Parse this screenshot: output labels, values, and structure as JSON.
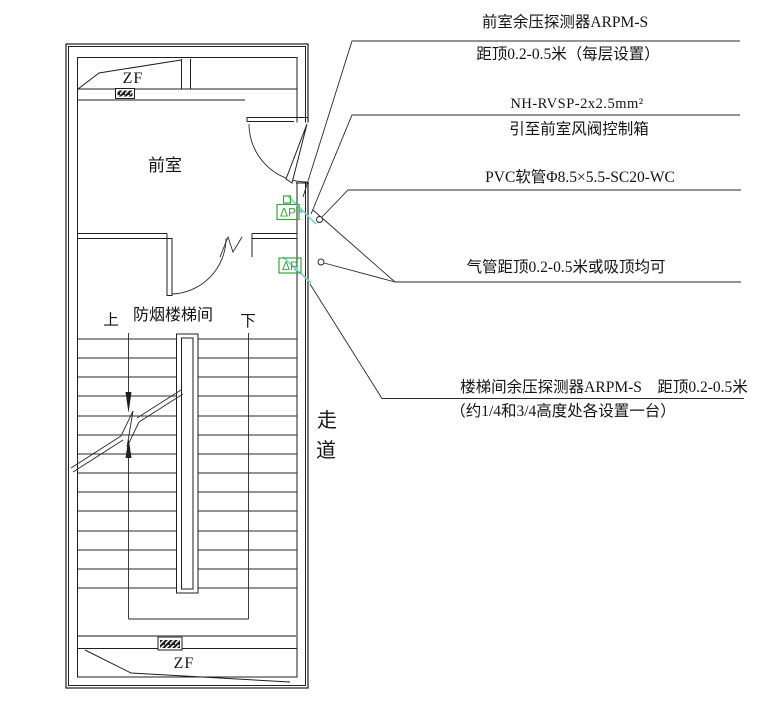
{
  "drawing": {
    "rooms": {
      "front_room": "前室",
      "stairwell": "防烟楼梯间",
      "corridor_chars": [
        "走",
        "道"
      ]
    },
    "stair_labels": {
      "up": "上",
      "down": "下"
    },
    "equipment": {
      "damper_top": "ZF",
      "damper_bottom": "ZF",
      "detector_symbol": "ΔP"
    },
    "annotations": {
      "front_detector_line1": "前室余压探测器ARPM-S",
      "front_detector_line2": "距顶0.2-0.5米（每层设置）",
      "cable_line1": "NH-RVSP-2x2.5mm²",
      "cable_line2": "引至前室风阀控制箱",
      "pvc_line": "PVC软管Φ8.5×5.5-SC20-WC",
      "tube_line": "气管距顶0.2-0.5米或吸顶均可",
      "stair_detector_line1": "楼梯间余压探测器ARPM-S　距顶0.2-0.5米",
      "stair_detector_line2": "（约1/4和3/4高度处各设置一台）"
    },
    "colors": {
      "line": "#1f1f1f",
      "detector_green": "#3aa73a",
      "tube_teal": "#82d2cf",
      "duct_gray": "#8a8a8a"
    }
  }
}
